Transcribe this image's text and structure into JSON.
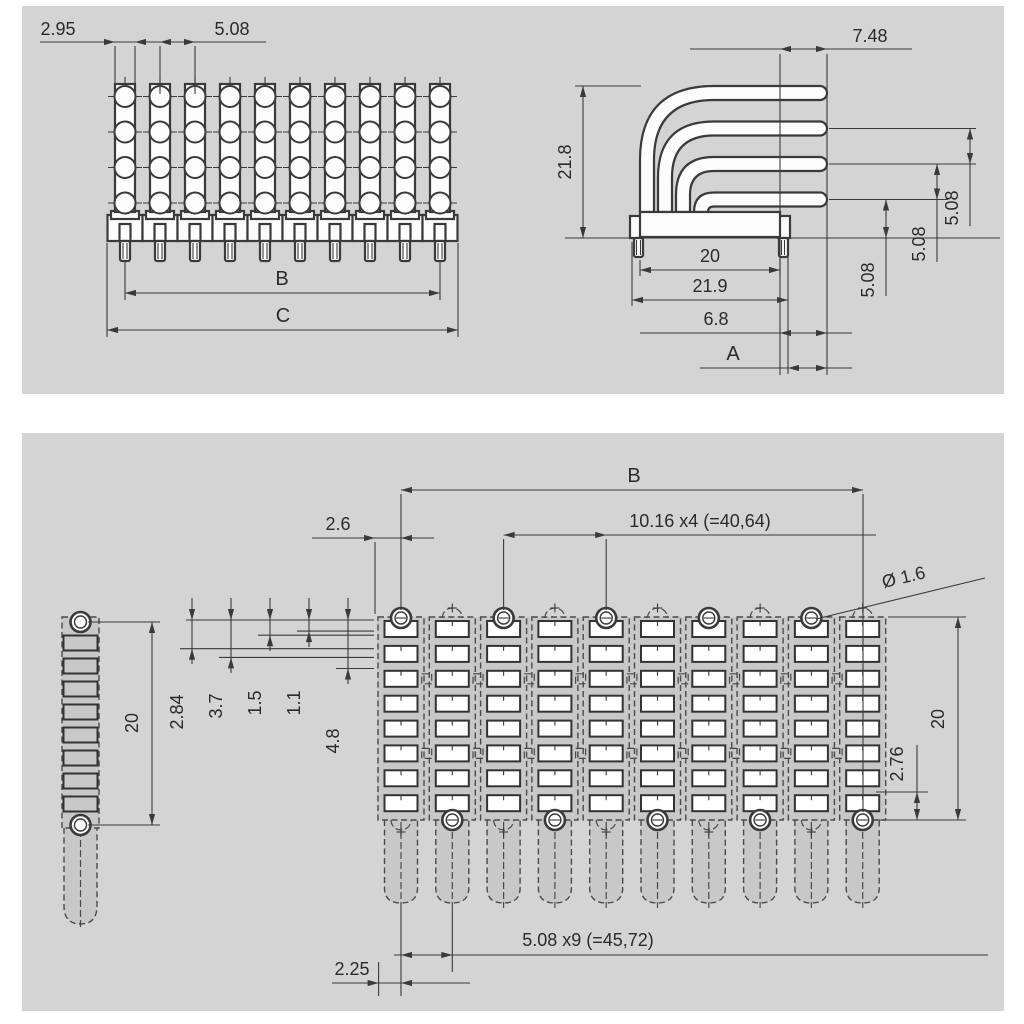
{
  "top_drawing": {
    "front_view": {
      "dim_led_width": "2.95",
      "dim_led_pitch": "5.08",
      "dim_b": "B",
      "dim_c": "C"
    },
    "side_view": {
      "dim_tip": "7.48",
      "dim_height": "21.8",
      "dim_pin_span": "20",
      "dim_body_width": "21.9",
      "dim_overhang": "6.8",
      "dim_a": "A",
      "dim_row_pitch": [
        "5.08",
        "5.08",
        "5.08"
      ]
    }
  },
  "bottom_drawing": {
    "footprint": {
      "dim_b": "B",
      "dim_edge_offset": "2.6",
      "dim_hole_pitch": "10.16 x4 (=40,64)",
      "dim_hole_diameter": "Ø 1.6",
      "dim_span": "20",
      "dim_pad_to_hole": "2.76",
      "stack_dims": [
        "2.84",
        "3.7",
        "1.5",
        "1.1",
        "4.8"
      ],
      "dim_pin_pitch": "5.08 x9 (=45,72)",
      "dim_pin_edge": "2.25"
    },
    "side_footprint": {
      "dim_span": "20"
    }
  },
  "colors": {
    "panel_background": "#d4d4d4",
    "copper_field": "#c8c8c8",
    "line": "#3a3a3a",
    "pad": "#ffffff"
  }
}
